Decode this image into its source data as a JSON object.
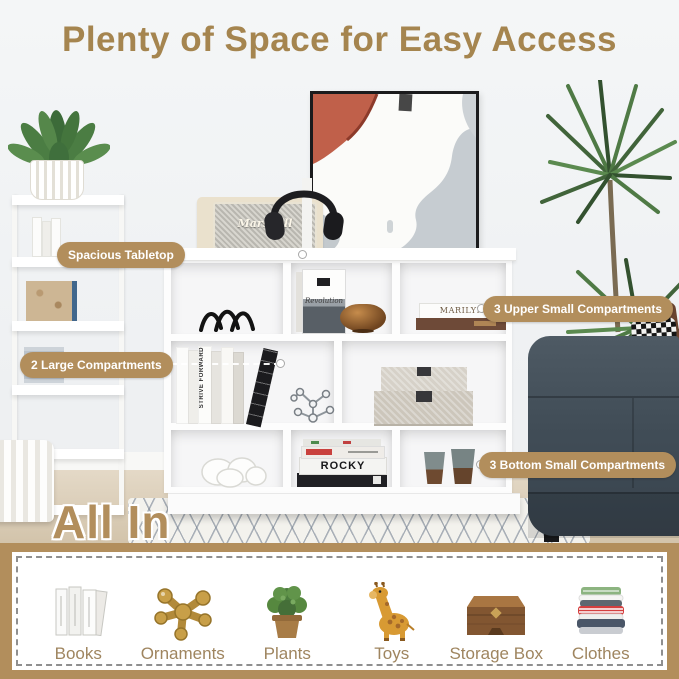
{
  "title": {
    "text": "Plenty of Space for Easy Access",
    "color": "#a5854f"
  },
  "callouts": [
    {
      "label": "Spacious Tabletop"
    },
    {
      "label": "2 Large Compartments"
    },
    {
      "label": "3 Upper Small Compartments"
    },
    {
      "label": "3 Bottom Small Compartments"
    }
  ],
  "callout_style": {
    "bg": "#b28e5c",
    "text_color": "#ffffff"
  },
  "scene": {
    "speaker_brand": "Marshall",
    "book_revolution": "Revolution",
    "book_marilyn": "MARILYN MONROE",
    "book_strive": "STRIVE FORWARD",
    "book_rocky": "ROCKY",
    "colors": {
      "wall": "#f1f3f4",
      "floor": "#d7c8b2",
      "shelf": "#ffffff",
      "sofa": "#46525c",
      "plant_green": "#4f7a45"
    }
  },
  "footer": {
    "title": "All In",
    "band_color": "#b28e5c",
    "label_color": "#9f855f",
    "items": [
      {
        "label": "Books",
        "icon": "books-icon"
      },
      {
        "label": "Ornaments",
        "icon": "ornaments-icon"
      },
      {
        "label": "Plants",
        "icon": "plants-icon"
      },
      {
        "label": "Toys",
        "icon": "toys-icon"
      },
      {
        "label": "Storage Box",
        "icon": "storage-box-icon"
      },
      {
        "label": "Clothes",
        "icon": "clothes-icon"
      }
    ]
  }
}
